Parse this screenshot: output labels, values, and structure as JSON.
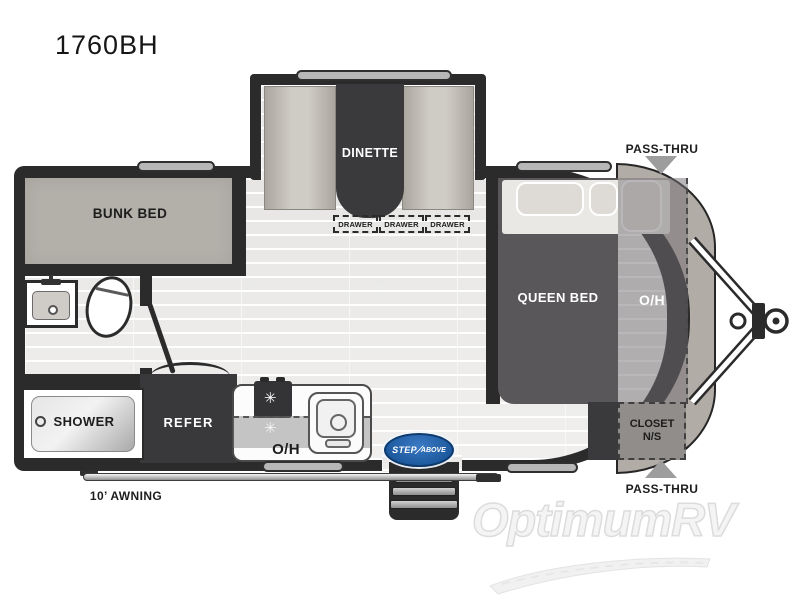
{
  "header": {
    "model": "1760BH"
  },
  "plan": {
    "bunk_bed_label": "BUNK BED",
    "dinette_label": "DINETTE",
    "drawer_labels": [
      "DRAWER",
      "DRAWER",
      "DRAWER"
    ],
    "queen_bed_label": "QUEEN BED",
    "front_overhead_label": "O/H",
    "kitchen_overhead_label": "O/H",
    "shower_label": "SHOWER",
    "refrigerator_label": "REFER",
    "closet_label_line1": "CLOSET",
    "closet_label_line2": "N/S",
    "pass_thru_top_label": "PASS-THRU",
    "pass_thru_bottom_label": "PASS-THRU",
    "awning_label": "10’ AWNING",
    "burner_glyph": "✳"
  },
  "branding": {
    "step_logo_word1": "STEP",
    "step_logo_divider": "⁄",
    "step_logo_word2": "ABOVE",
    "watermark": "OptimumRV"
  },
  "colors": {
    "wall": "#2c2b2c",
    "floor": "#ebebeb",
    "bunk_fill": "#b3afa9",
    "bed_fill": "#59575a",
    "furniture_dark": "#3a393b",
    "nose_cap": "#b2aca6",
    "logo_blue": "#1d5a9e",
    "arrow_gray": "#9d9d9d"
  }
}
